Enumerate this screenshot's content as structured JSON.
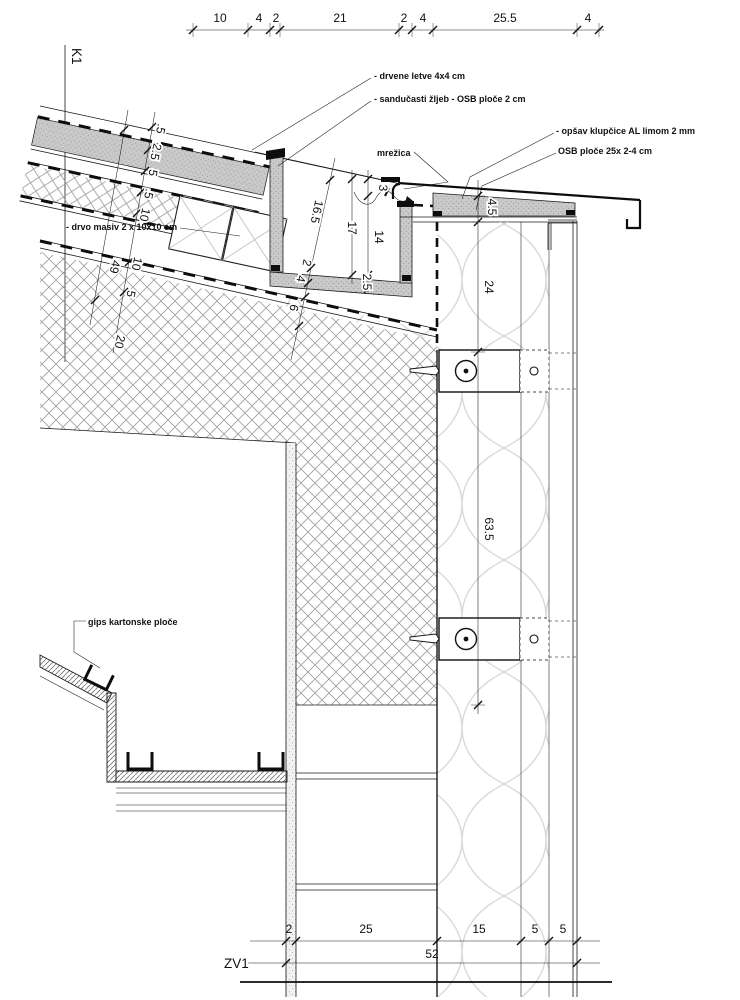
{
  "drawing": {
    "grid_label": "K1",
    "level_label": "ZV1",
    "labels": {
      "battens": "- drvene letve 4x4 cm",
      "box_gutter": "- sandučasti žljeb - OSB ploče 2 cm",
      "mesh": "mrežica",
      "sill_flashing": "- opšav klupčice AL limom 2 mm",
      "sill_osb": "OSB ploče 25x 2-4 cm",
      "solid_wood": "- drvo masiv 2 x 10x10 cm",
      "gypsum": "gips kartonske ploče"
    },
    "dims": {
      "top_chain": [
        "10",
        "4",
        "2",
        "21",
        "2",
        "4",
        "25.5",
        "4"
      ],
      "roof_layers": [
        ".5",
        "2.5",
        "5",
        ".5",
        "10",
        "10",
        "5"
      ],
      "roof_total": "49",
      "roof_depth": "20",
      "gutter_gap": "3",
      "gutter_left": "16.5",
      "gutter_mid": "17",
      "gutter_right": "14",
      "gutter_bottom": "2.5",
      "gutter_b1": "2",
      "gutter_b2": "4",
      "gutter_b3": "6",
      "sill": "4.5",
      "parapet": "24",
      "wall_span": "63.5",
      "bottom_chain": [
        "2",
        "25",
        "15",
        "5",
        "5"
      ],
      "bottom_total": "52"
    }
  }
}
